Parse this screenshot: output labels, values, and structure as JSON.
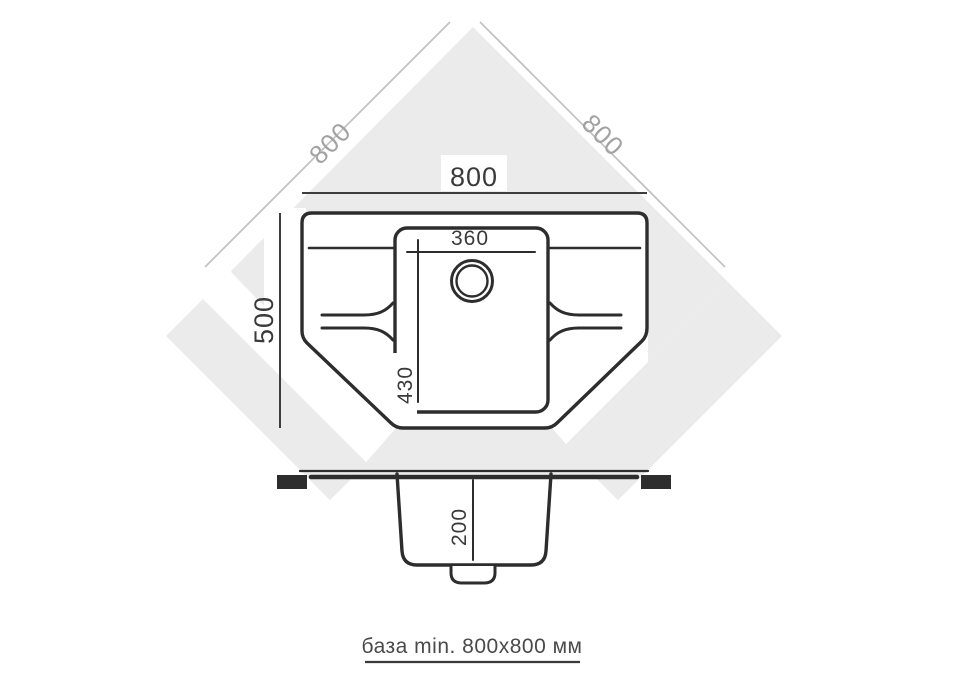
{
  "title": "corner-sink-installation-diagram",
  "dimensions": {
    "top_width": "800",
    "diagonal_left": "800",
    "diagonal_right": "800",
    "depth": "500",
    "bowl_width": "360",
    "bowl_length": "430",
    "bowl_depth": "200"
  },
  "caption": {
    "text": "база min. 800x800 мм"
  },
  "colors": {
    "counter_gray": "#ebebeb",
    "ink": "#2d2d2d",
    "dim_line": "#3d3d3d",
    "faded_line": "#c2c2c2",
    "faded_text": "#a2a2a2",
    "caption_ink": "#4a4a4a",
    "white": "#ffffff"
  }
}
